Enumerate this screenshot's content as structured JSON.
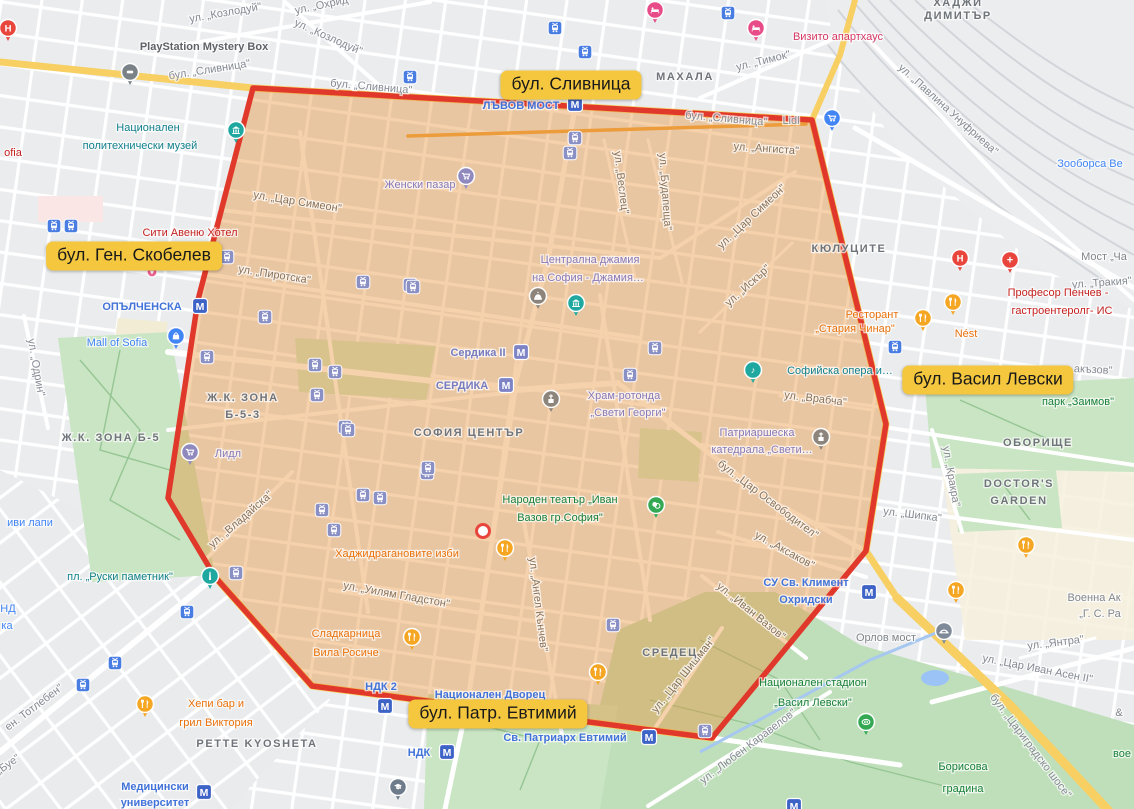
{
  "annotations": [
    {
      "id": "slivnitsa",
      "text": "бул. Сливница",
      "x": 571,
      "y": 85
    },
    {
      "id": "gen-skobelev",
      "text": "бул. Ген. Скобелев",
      "x": 134,
      "y": 256
    },
    {
      "id": "vasil-levski",
      "text": "бул. Васил Левски",
      "x": 988,
      "y": 380
    },
    {
      "id": "patr-evtimiy",
      "text": "бул. Патр. Евтимий",
      "x": 498,
      "y": 714
    }
  ],
  "region": {
    "points": "253,88 812,120 886,424 866,551 712,738 312,686 215,577 168,498 198,300",
    "fill": "#E8913A",
    "fill_opacity": 0.42,
    "border": "#E0392B",
    "border_width": 5.5
  },
  "location_dot": {
    "x": 483,
    "y": 531
  },
  "theme": {
    "metro_blue": "#3E63C6",
    "metro_violet": "#7D83C4",
    "tram_blue": "#4A7DE2",
    "tram_violet": "#8A8FC4",
    "metro_glyph": "М",
    "pin_colors": {
      "fork": "#F5A623",
      "cartv": "#9089BE",
      "cartb": "#4285F4",
      "bag": "#4285F4",
      "museum": "#1FA8A0",
      "music": "#1FA8A0",
      "monument": "#1FA8A0",
      "church": "#8D847B",
      "mosque": "#8D847B",
      "bed": "#E84C88",
      "hospH": "#E8453C",
      "hospP": "#E8453C",
      "bridge": "#7E8A97",
      "masks": "#34A853",
      "stadium": "#34A853",
      "grad": "#6E7B8A",
      "ps": "#7A8187",
      "heart": "#F06292"
    }
  },
  "map": {
    "labels": [
      {
        "t": "ул. „Козлодуй\"",
        "x": 226,
        "y": 16,
        "r": -10,
        "c": "st"
      },
      {
        "t": "ул. „Козлодуй\"",
        "x": 327,
        "y": 40,
        "r": 24,
        "c": "st"
      },
      {
        "t": "ул. „Охрид\"",
        "x": 324,
        "y": 8,
        "r": -12,
        "c": "st"
      },
      {
        "t": "бул. „Сливница\"",
        "x": 210,
        "y": 73,
        "r": -9,
        "c": "st"
      },
      {
        "t": "бул. „Сливница\"",
        "x": 371,
        "y": 90,
        "r": 5,
        "c": "st"
      },
      {
        "t": "бул. „Сливница\"",
        "x": 726,
        "y": 122,
        "r": 5,
        "c": "st"
      },
      {
        "t": "ул. „Тимок\"",
        "x": 764,
        "y": 64,
        "r": -14,
        "c": "st"
      },
      {
        "t": "ул. „Ангиста\"",
        "x": 766,
        "y": 152,
        "r": 4,
        "c": "sti"
      },
      {
        "t": "ул. „Павлина Унуфриева\"",
        "x": 946,
        "y": 112,
        "r": 42,
        "c": "st"
      },
      {
        "t": "ул. „Веслец\"",
        "x": 618,
        "y": 183,
        "r": 83,
        "c": "sti"
      },
      {
        "t": "ул. „Будапеща\"",
        "x": 662,
        "y": 192,
        "r": 86,
        "c": "sti"
      },
      {
        "t": "ул. „Цар Симеон\"",
        "x": 297,
        "y": 205,
        "r": 9,
        "c": "sti"
      },
      {
        "t": "ул. „Цар Симеон\"",
        "x": 754,
        "y": 219,
        "r": -43,
        "c": "sti"
      },
      {
        "t": "ул. „Искър\"",
        "x": 750,
        "y": 288,
        "r": -42,
        "c": "sti"
      },
      {
        "t": "ул. „Пиротска\"",
        "x": 274,
        "y": 278,
        "r": 9,
        "c": "sti"
      },
      {
        "t": "ул. „Одрин\"",
        "x": 33,
        "y": 368,
        "r": 80,
        "c": "st"
      },
      {
        "t": "ул. „Владайска\"",
        "x": 243,
        "y": 522,
        "r": -41,
        "c": "sti"
      },
      {
        "t": "ул. „Врабча\"",
        "x": 815,
        "y": 402,
        "r": 7,
        "c": "sti"
      },
      {
        "t": "ул. „Тракия\"",
        "x": 1102,
        "y": 286,
        "r": -4,
        "c": "st"
      },
      {
        "t": "бул. „Цар Освободител\"",
        "x": 766,
        "y": 502,
        "r": 37,
        "c": "sti"
      },
      {
        "t": "ул. „Аксаков\"",
        "x": 783,
        "y": 553,
        "r": 29,
        "c": "sti"
      },
      {
        "t": "ул. „Уилям Гладстон\"",
        "x": 396,
        "y": 598,
        "r": 10,
        "c": "sti"
      },
      {
        "t": "ул. „Ангел Кънчев\"",
        "x": 535,
        "y": 605,
        "r": 83,
        "c": "sti"
      },
      {
        "t": "ул. „Иван Вазов\"",
        "x": 749,
        "y": 614,
        "r": 39,
        "c": "sti"
      },
      {
        "t": "ул. „Цар Шишман\"",
        "x": 686,
        "y": 677,
        "r": -51,
        "c": "sti"
      },
      {
        "t": "ул. „Кракра\"",
        "x": 948,
        "y": 477,
        "r": 80,
        "c": "st"
      },
      {
        "t": "ул. „Шипка\"",
        "x": 912,
        "y": 518,
        "r": 7,
        "c": "st"
      },
      {
        "t": "бул. „Цариградско шосе\"",
        "x": 1028,
        "y": 748,
        "r": 53,
        "c": "st"
      },
      {
        "t": "ул. „Цар Иван Асен II\"",
        "x": 1037,
        "y": 672,
        "r": 11,
        "c": "st"
      },
      {
        "t": "ул. „Янтра\"",
        "x": 1056,
        "y": 646,
        "r": -7,
        "c": "st"
      },
      {
        "t": "ул. „Любен Каравелов\"",
        "x": 750,
        "y": 749,
        "r": -37,
        "c": "st"
      },
      {
        "t": "ен. Тотлебен\"",
        "x": 36,
        "y": 710,
        "r": -37,
        "c": "st"
      },
      {
        "t": "„Буе\"",
        "x": 10,
        "y": 767,
        "r": -35,
        "c": "st"
      },
      {
        "t": "акъзов\"",
        "x": 1093,
        "y": 373,
        "r": 3,
        "c": "st"
      },
      {
        "t": "Lidl",
        "x": 791,
        "y": 124,
        "r": 0,
        "c": "st",
        "s": 10
      },
      {
        "t": "ХАДЖИ",
        "x": 958,
        "y": 6,
        "c": "ar",
        "s": 14
      },
      {
        "t": "ДИМИТЪР",
        "x": 958,
        "y": 19,
        "c": "ar",
        "s": 14
      },
      {
        "t": "МАХАЛА",
        "x": 685,
        "y": 80,
        "c": "ar",
        "s": 14
      },
      {
        "t": "КЮЛУЦИТЕ",
        "x": 849,
        "y": 252,
        "c": "ar",
        "s": 14
      },
      {
        "t": "Ж.К. ЗОНА",
        "x": 243,
        "y": 401,
        "c": "ar",
        "s": 13
      },
      {
        "t": "Б-5-3",
        "x": 243,
        "y": 418,
        "c": "ar",
        "s": 13
      },
      {
        "t": "Ж.К. ЗОНА Б-5",
        "x": 111,
        "y": 441,
        "c": "ar",
        "s": 13
      },
      {
        "t": "СОФИЯ ЦЕНТЪР",
        "x": 469,
        "y": 436,
        "c": "ar",
        "s": 16
      },
      {
        "t": "СРЕДЕЦ",
        "x": 670,
        "y": 656,
        "c": "ar",
        "s": 13
      },
      {
        "t": "ОБОРИЩЕ",
        "x": 1038,
        "y": 446,
        "c": "ar",
        "s": 12
      },
      {
        "t": "DOCTOR'S",
        "x": 1019,
        "y": 487,
        "c": "ar",
        "s": 13
      },
      {
        "t": "GARDEN",
        "x": 1019,
        "y": 504,
        "c": "ar",
        "s": 13
      },
      {
        "t": "PETTE KYOSHETA",
        "x": 257,
        "y": 747,
        "c": "ar",
        "s": 13
      },
      {
        "t": "ЛЪВОВ МОСТ",
        "x": 521,
        "y": 109,
        "c": "tr"
      },
      {
        "t": "ОПЪЛЧЕНСКА",
        "x": 142,
        "y": 310,
        "c": "tr"
      },
      {
        "t": "Св. Патриарх Евтимий",
        "x": 565,
        "y": 741,
        "c": "tr"
      },
      {
        "t": "НДК",
        "x": 419,
        "y": 756,
        "c": "tr"
      },
      {
        "t": "НДК 2",
        "x": 381,
        "y": 690,
        "c": "tr"
      },
      {
        "t": "Национален Дворец",
        "x": 490,
        "y": 698,
        "c": "tr"
      },
      {
        "t": "Медицински",
        "x": 155,
        "y": 790,
        "c": "tr"
      },
      {
        "t": "университет",
        "x": 155,
        "y": 806,
        "c": "tr"
      },
      {
        "t": "СУ Св. Климент",
        "x": 806,
        "y": 586,
        "c": "tr"
      },
      {
        "t": "Охридски",
        "x": 806,
        "y": 603,
        "c": "tr"
      },
      {
        "t": "Сердика II",
        "x": 478,
        "y": 356,
        "c": "trv"
      },
      {
        "t": "СЕРДИКА",
        "x": 462,
        "y": 389,
        "c": "trv"
      },
      {
        "t": "Национален",
        "x": 148,
        "y": 131,
        "c": "cv"
      },
      {
        "t": "политехнически музей",
        "x": 140,
        "y": 149,
        "c": "cv"
      },
      {
        "t": "пл. „Руски паметник\"",
        "x": 120,
        "y": 580,
        "c": "cv"
      },
      {
        "t": "Софийска опера и…",
        "x": 840,
        "y": 374,
        "c": "cv"
      },
      {
        "t": "парк „Заимов\"",
        "x": 1078,
        "y": 405,
        "c": "gr"
      },
      {
        "t": "Народен театър „Иван",
        "x": 560,
        "y": 503,
        "c": "gr"
      },
      {
        "t": "Вазов гр.София\"",
        "x": 560,
        "y": 521,
        "c": "gr"
      },
      {
        "t": "Национален стадион",
        "x": 813,
        "y": 686,
        "c": "gr"
      },
      {
        "t": "„Васил Левски\"",
        "x": 813,
        "y": 706,
        "c": "gr"
      },
      {
        "t": "Борисова",
        "x": 963,
        "y": 770,
        "c": "gr"
      },
      {
        "t": "градина",
        "x": 963,
        "y": 792,
        "c": "gr"
      },
      {
        "t": "вое",
        "x": 1122,
        "y": 757,
        "c": "gr"
      },
      {
        "t": "Сити Авеню Хотел",
        "x": 190,
        "y": 236,
        "c": "rd"
      },
      {
        "t": "Професор Пенчев -",
        "x": 1058,
        "y": 296,
        "c": "rd"
      },
      {
        "t": "гастроентеролг- ИС",
        "x": 1062,
        "y": 314,
        "c": "rd"
      },
      {
        "t": "ofia",
        "x": 13,
        "y": 156,
        "c": "rd"
      },
      {
        "t": "Визито апартхаус",
        "x": 838,
        "y": 40,
        "c": "pk"
      },
      {
        "t": "Хаджидрагановите изби",
        "x": 397,
        "y": 557,
        "c": "fd"
      },
      {
        "t": "Сладкарница",
        "x": 346,
        "y": 637,
        "c": "fd"
      },
      {
        "t": "Вила Росиче",
        "x": 346,
        "y": 656,
        "c": "fd"
      },
      {
        "t": "Хепи бар и",
        "x": 216,
        "y": 707,
        "c": "fd"
      },
      {
        "t": "грил Виктория",
        "x": 216,
        "y": 726,
        "c": "fd"
      },
      {
        "t": "Ресторант",
        "x": 872,
        "y": 318,
        "c": "fd"
      },
      {
        "t": "„Стария Чинар\"",
        "x": 855,
        "y": 332,
        "c": "fd"
      },
      {
        "t": "Nést",
        "x": 966,
        "y": 337,
        "c": "fd"
      },
      {
        "t": "Женски пазар",
        "x": 420,
        "y": 188,
        "c": "sh"
      },
      {
        "t": "Лидл",
        "x": 228,
        "y": 457,
        "c": "sh"
      },
      {
        "t": "Централна джамия",
        "x": 590,
        "y": 263,
        "c": "sh"
      },
      {
        "t": "на София - Джамия…",
        "x": 588,
        "y": 281,
        "c": "sh"
      },
      {
        "t": "Храм-ротонда",
        "x": 624,
        "y": 399,
        "c": "sh"
      },
      {
        "t": "„Свети Георги\"",
        "x": 628,
        "y": 416,
        "c": "sh"
      },
      {
        "t": "Патриаршеска",
        "x": 757,
        "y": 436,
        "c": "sh"
      },
      {
        "t": "катедрала „Свети…",
        "x": 762,
        "y": 453,
        "c": "sh"
      },
      {
        "t": "Mall of Sofia",
        "x": 117,
        "y": 346,
        "c": "shb"
      },
      {
        "t": "Зооборса Ве",
        "x": 1090,
        "y": 167,
        "c": "shb"
      },
      {
        "t": "иви лапи",
        "x": 30,
        "y": 526,
        "c": "shb"
      },
      {
        "t": "НД",
        "x": 8,
        "y": 612,
        "c": "shb"
      },
      {
        "t": "ка",
        "x": 7,
        "y": 629,
        "c": "shb"
      },
      {
        "t": "PlayStation Mystery Box",
        "x": 204,
        "y": 50,
        "c": "dk"
      },
      {
        "t": "Мост „Ча",
        "x": 1104,
        "y": 260,
        "c": "gy"
      },
      {
        "t": "Орлов мост",
        "x": 886,
        "y": 641,
        "c": "gy",
        "s": 13
      },
      {
        "t": "Военна Ак",
        "x": 1094,
        "y": 601,
        "c": "gy"
      },
      {
        "t": "„Г. С. Ра",
        "x": 1100,
        "y": 617,
        "c": "gy"
      },
      {
        "t": "&",
        "x": 1119,
        "y": 716,
        "c": "gy"
      }
    ],
    "metro": [
      {
        "x": 575,
        "y": 104
      },
      {
        "x": 200,
        "y": 306
      },
      {
        "x": 521,
        "y": 352,
        "v": 1
      },
      {
        "x": 506,
        "y": 385,
        "v": 1
      },
      {
        "x": 869,
        "y": 592
      },
      {
        "x": 649,
        "y": 737
      },
      {
        "x": 447,
        "y": 752
      },
      {
        "x": 385,
        "y": 706
      },
      {
        "x": 204,
        "y": 792
      },
      {
        "x": 794,
        "y": 806
      }
    ],
    "trams": [
      {
        "x": 54,
        "y": 226
      },
      {
        "x": 71,
        "y": 226
      },
      {
        "x": 410,
        "y": 77
      },
      {
        "x": 555,
        "y": 28
      },
      {
        "x": 585,
        "y": 52
      },
      {
        "x": 728,
        "y": 13
      },
      {
        "x": 187,
        "y": 612
      },
      {
        "x": 115,
        "y": 663
      },
      {
        "x": 83,
        "y": 685
      },
      {
        "x": 895,
        "y": 347
      },
      {
        "x": 227,
        "y": 257,
        "v": 1
      },
      {
        "x": 363,
        "y": 282,
        "v": 1
      },
      {
        "x": 410,
        "y": 285,
        "v": 1
      },
      {
        "x": 265,
        "y": 317,
        "v": 1
      },
      {
        "x": 315,
        "y": 365,
        "v": 1
      },
      {
        "x": 335,
        "y": 372,
        "v": 1
      },
      {
        "x": 317,
        "y": 395,
        "v": 1
      },
      {
        "x": 345,
        "y": 427,
        "v": 1
      },
      {
        "x": 207,
        "y": 357,
        "v": 1
      },
      {
        "x": 348,
        "y": 430,
        "v": 1
      },
      {
        "x": 427,
        "y": 473,
        "v": 1
      },
      {
        "x": 363,
        "y": 495,
        "v": 1
      },
      {
        "x": 380,
        "y": 498,
        "v": 1
      },
      {
        "x": 322,
        "y": 510,
        "v": 1
      },
      {
        "x": 334,
        "y": 530,
        "v": 1
      },
      {
        "x": 236,
        "y": 573,
        "v": 1
      },
      {
        "x": 575,
        "y": 138,
        "v": 1
      },
      {
        "x": 570,
        "y": 153,
        "v": 1
      },
      {
        "x": 413,
        "y": 287,
        "v": 1
      },
      {
        "x": 428,
        "y": 468,
        "v": 1
      },
      {
        "x": 655,
        "y": 348,
        "v": 1
      },
      {
        "x": 630,
        "y": 375,
        "v": 1
      },
      {
        "x": 613,
        "y": 625,
        "v": 1
      },
      {
        "x": 705,
        "y": 731,
        "v": 1
      }
    ],
    "pins": [
      {
        "t": "fork",
        "x": 505,
        "y": 548
      },
      {
        "t": "fork",
        "x": 412,
        "y": 637
      },
      {
        "t": "fork",
        "x": 145,
        "y": 704
      },
      {
        "t": "fork",
        "x": 923,
        "y": 318
      },
      {
        "t": "fork",
        "x": 953,
        "y": 302
      },
      {
        "t": "fork",
        "x": 598,
        "y": 672
      },
      {
        "t": "fork",
        "x": 1026,
        "y": 545
      },
      {
        "t": "fork",
        "x": 956,
        "y": 590
      },
      {
        "t": "cartv",
        "x": 466,
        "y": 176
      },
      {
        "t": "cartv",
        "x": 190,
        "y": 452
      },
      {
        "t": "cartb",
        "x": 832,
        "y": 118
      },
      {
        "t": "bag",
        "x": 176,
        "y": 336
      },
      {
        "t": "museum",
        "x": 236,
        "y": 130
      },
      {
        "t": "museum",
        "x": 576,
        "y": 303
      },
      {
        "t": "music",
        "x": 753,
        "y": 370
      },
      {
        "t": "monument",
        "x": 210,
        "y": 576
      },
      {
        "t": "church",
        "x": 551,
        "y": 399
      },
      {
        "t": "church",
        "x": 821,
        "y": 437
      },
      {
        "t": "mosque",
        "x": 538,
        "y": 296
      },
      {
        "t": "bed",
        "x": 655,
        "y": 10
      },
      {
        "t": "bed",
        "x": 756,
        "y": 28
      },
      {
        "t": "hospH",
        "x": 8,
        "y": 28
      },
      {
        "t": "hospH",
        "x": 960,
        "y": 258
      },
      {
        "t": "hospP",
        "x": 1010,
        "y": 260
      },
      {
        "t": "bridge",
        "x": 944,
        "y": 631
      },
      {
        "t": "masks",
        "x": 656,
        "y": 505
      },
      {
        "t": "stadium",
        "x": 866,
        "y": 722
      },
      {
        "t": "grad",
        "x": 398,
        "y": 787
      },
      {
        "t": "ps",
        "x": 130,
        "y": 72
      },
      {
        "t": "heart",
        "x": 152,
        "y": 272
      }
    ]
  }
}
